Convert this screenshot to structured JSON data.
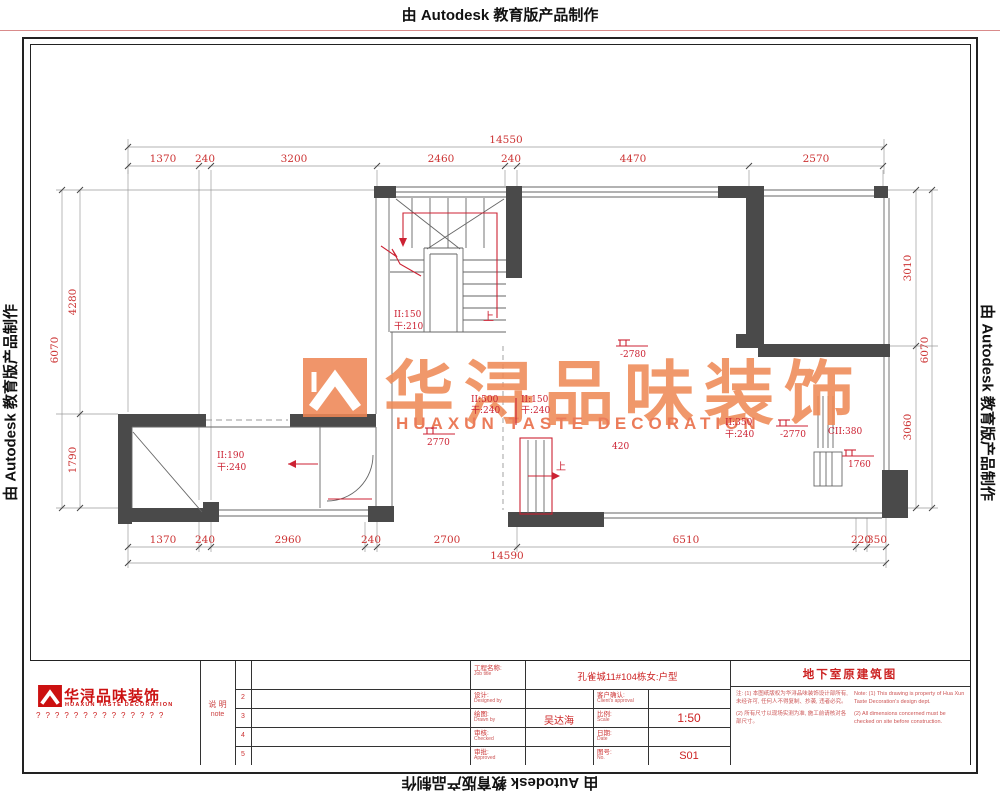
{
  "frame": {
    "autodesk_text": "由 Autodesk 教育版产品制作"
  },
  "watermark": {
    "cn": "华浔品味装饰",
    "en": "HUAXUN TASTE DECORATION"
  },
  "plan": {
    "dims": {
      "top_total": "14550",
      "top": [
        "1370",
        "240",
        "3200",
        "2460",
        "240",
        "4470",
        "2570"
      ],
      "bottom": [
        "1370",
        "240",
        "2960",
        "240",
        "2700",
        "6510",
        "220",
        "350"
      ],
      "bottom_total": "14590",
      "left": [
        "4280",
        "1790"
      ],
      "left_total": "6070",
      "right": [
        "3010",
        "3060"
      ],
      "right_total": "6070"
    },
    "labels": {
      "stair_riser": "II:150",
      "stair_tread": "干:210",
      "up1": "上",
      "up2": "上",
      "c1a": "II:500",
      "c1b": "干:240",
      "c2a": "II:150",
      "c2b": "干:240",
      "left_a": "II:190",
      "left_b": "干:240",
      "right_a": "II:350",
      "right_b": "干:240",
      "cii": "CII:380",
      "n420": "420",
      "elev1": "-2780",
      "elev2": "2770",
      "elev3": "-2770",
      "elev4": "1760"
    }
  },
  "titleblock": {
    "company_cn": "华浔品味装饰",
    "company_en": "HUAXUN TASTE DECORATION",
    "phone_row": "??????????????",
    "note_label_cn": "说 明",
    "note_label_en": "note",
    "row_numbers": [
      "2",
      "3",
      "4",
      "5"
    ],
    "fields": {
      "job_label": "工程名称:",
      "job_label_en": "Job title",
      "job_value": "孔雀城11#104栋女:户型",
      "design_label": "设计:",
      "design_label_en": "Designed by",
      "draw_label": "绘图:",
      "draw_label_en": "Drawn by",
      "draw_value": "吴达海",
      "check_label": "审核:",
      "check_label_en": "Checked",
      "approve_label": "审批:",
      "approve_label_en": "Approved",
      "client_label": "客户确认:",
      "client_label_en": "Client's approval",
      "scale_label": "比例:",
      "scale_label_en": "Scale",
      "scale_value": "1:50",
      "date_label": "日期:",
      "date_label_en": "Date",
      "no_label": "图号:",
      "no_label_en": "No.",
      "no_value": "S01"
    },
    "sheet_title": "地下室原建筑图",
    "notes_cn_1": "注: (1) 本图纸版权为华浔品味装饰设计部所有, 未经许可, 任何人不得复制、抄袭, 违者必究。",
    "notes_cn_2": "(2) 所有尺寸以现场实测为准, 施工前请核对各部尺寸。",
    "notes_en_1": "Note: (1) This drawing is property of Hua Xun Taste Decoration's design dept.",
    "notes_en_2": "(2) All dimensions concerned must be checked on site before construction."
  }
}
